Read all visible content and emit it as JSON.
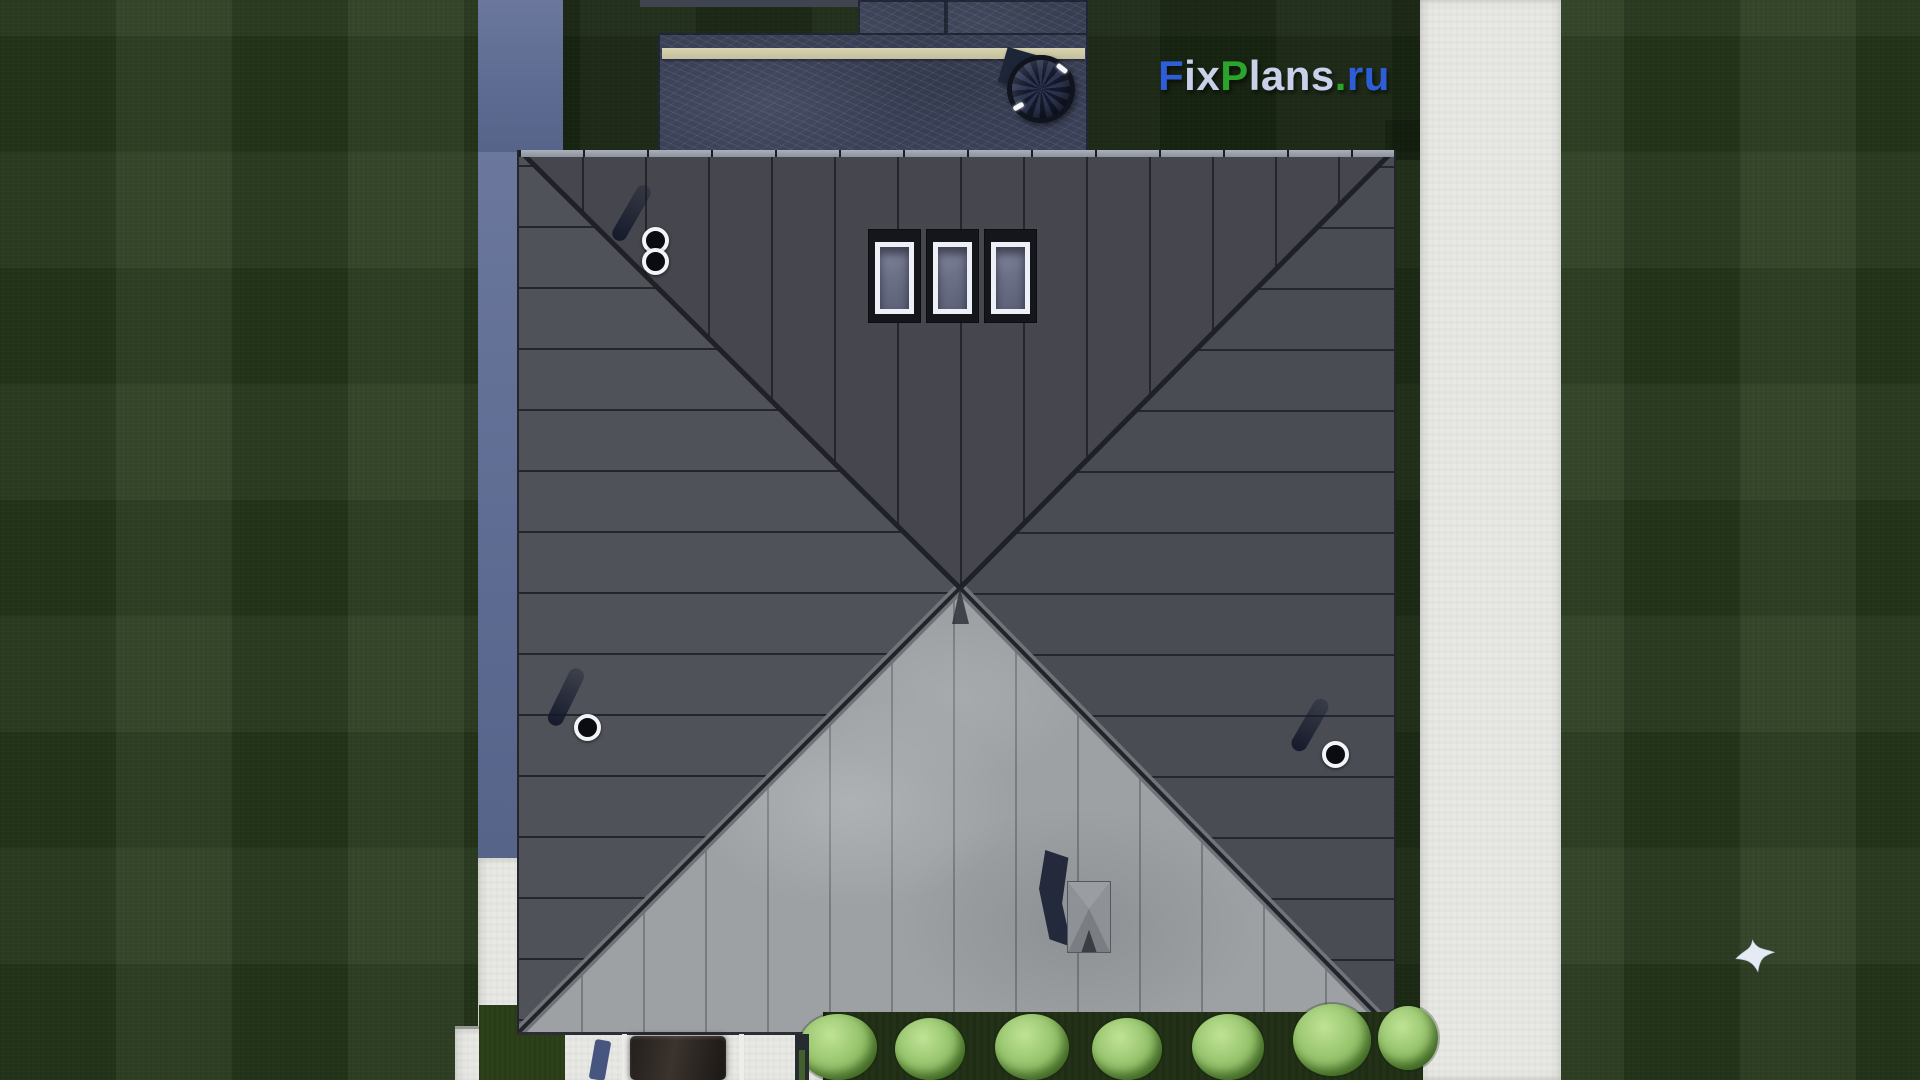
{
  "scene": {
    "description": "Top-down aerial 3D render of a house with a pyramidal hip roof, surrounded by lawns, white concrete paths, a pool terrace with round rattan chair and beige bench, a hedge of round bushes, a car under a carport, and a white bird flying over the right lawn."
  },
  "watermark": {
    "text": "FixPlans.ru",
    "parts": [
      {
        "text": "F",
        "color": "#2e5ed7"
      },
      {
        "text": "ix",
        "color": "#c9d0e9"
      },
      {
        "text": "P",
        "color": "#2aa42b"
      },
      {
        "text": "lans",
        "color": "#c9d0e9"
      },
      {
        "text": ".",
        "color": "#2aa42b"
      },
      {
        "text": "ru",
        "color": "#2e5ed7"
      }
    ]
  },
  "palette": {
    "lawn_green": "#283a1d",
    "roof_dark": "#47484f",
    "roof_light_face": "#9da1a4",
    "terrace_blue": "#3a4157",
    "bench_beige": "#d0cbaa",
    "path_white": "#e8e8e5",
    "wall_blue": "#5d6b92",
    "bush_green": "#9cc878",
    "skylight_frame": "#edf0f6"
  },
  "objects": {
    "skylight_count": 3,
    "roof_vent_count": 3,
    "bush_count": 7,
    "items": [
      "hip-roof",
      "skylights",
      "roof-vents",
      "chimney",
      "pool-terrace",
      "rattan-chair",
      "bench",
      "hedge",
      "car",
      "bird"
    ]
  }
}
